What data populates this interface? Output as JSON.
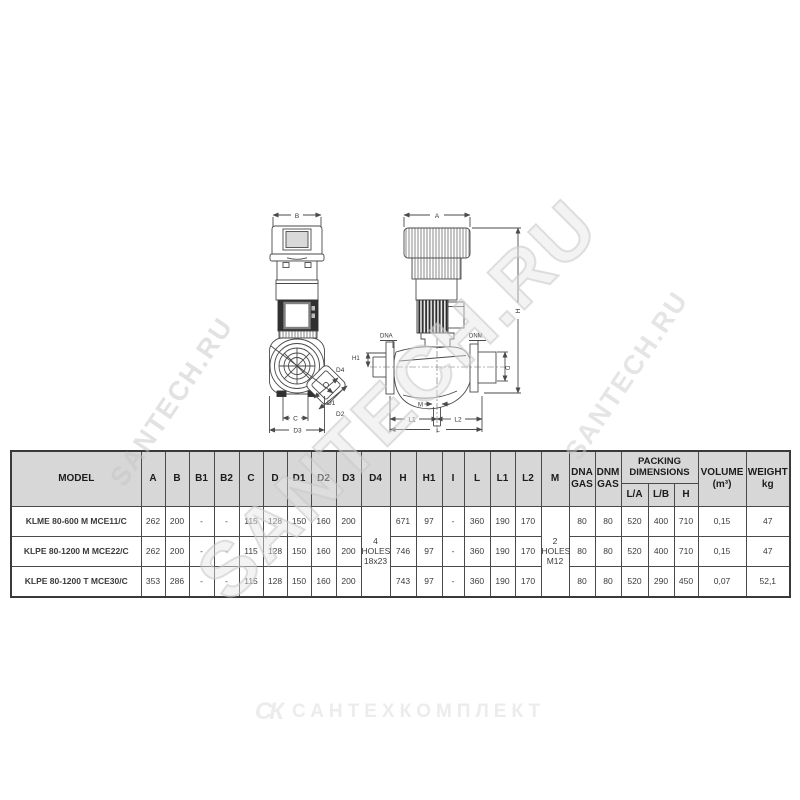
{
  "watermarks": {
    "small_left": "SANTECH.RU",
    "large": "SANTECH.RU",
    "small_right": "SANTECH.RU",
    "footer_glyph": "СК",
    "footer_text": "САНТЕХКОМПЛЕКТ"
  },
  "drawings": {
    "front_view": {
      "b": "B",
      "d4": "D4",
      "d1": "D1",
      "d2": "D2",
      "c": "C",
      "d3": "D3"
    },
    "side_view": {
      "a": "A",
      "h": "H",
      "h1": "H1",
      "dna": "DNA",
      "dnm": "DNM",
      "d": "D",
      "m": "M",
      "l1": "L1",
      "l2": "L2",
      "l": "L"
    }
  },
  "table": {
    "headers": {
      "model": "MODEL",
      "a": "A",
      "b": "B",
      "b1": "B1",
      "b2": "B2",
      "c": "C",
      "d": "D",
      "d1": "D1",
      "d2": "D2",
      "d3": "D3",
      "d4": "D4",
      "h": "H",
      "h1": "H1",
      "i": "I",
      "l": "L",
      "l1": "L1",
      "l2": "L2",
      "m": "M",
      "dna1": "DNA",
      "dna2": "GAS",
      "dnm1": "DNM",
      "dnm2": "GAS",
      "packing1": "PACKING",
      "packing2": "DIMENSIONS",
      "la": "L/A",
      "lb": "L/B",
      "ph": "H",
      "volume1": "VOLUME",
      "volume2": "(m³)",
      "weight1": "WEIGHT",
      "weight2": "kg"
    },
    "shared": {
      "d4": [
        "4",
        "HOLES",
        "18x23"
      ],
      "m": [
        "2",
        "HOLES",
        "M12"
      ]
    },
    "rows": [
      {
        "model": "KLME 80-600 M MCE11/C",
        "a": "262",
        "b": "200",
        "b1": "-",
        "b2": "-",
        "c": "115",
        "d": "128",
        "d1": "150",
        "d2": "160",
        "d3": "200",
        "h": "671",
        "h1": "97",
        "i": "-",
        "l": "360",
        "l1": "190",
        "l2": "170",
        "dna": "80",
        "dnm": "80",
        "la": "520",
        "lb": "400",
        "ph": "710",
        "volume": "0,15",
        "weight": "47"
      },
      {
        "model": "KLPE 80-1200 M MCE22/C",
        "a": "262",
        "b": "200",
        "b1": "-",
        "b2": "-",
        "c": "115",
        "d": "128",
        "d1": "150",
        "d2": "160",
        "d3": "200",
        "h": "746",
        "h1": "97",
        "i": "-",
        "l": "360",
        "l1": "190",
        "l2": "170",
        "dna": "80",
        "dnm": "80",
        "la": "520",
        "lb": "400",
        "ph": "710",
        "volume": "0,15",
        "weight": "47"
      },
      {
        "model": "KLPE 80-1200 T MCE30/C",
        "a": "353",
        "b": "286",
        "b1": "-",
        "b2": "-",
        "c": "115",
        "d": "128",
        "d1": "150",
        "d2": "160",
        "d3": "200",
        "h": "743",
        "h1": "97",
        "i": "-",
        "l": "360",
        "l1": "190",
        "l2": "170",
        "dna": "80",
        "dnm": "80",
        "la": "520",
        "lb": "290",
        "ph": "450",
        "volume": "0,07",
        "weight": "52,1"
      }
    ]
  }
}
